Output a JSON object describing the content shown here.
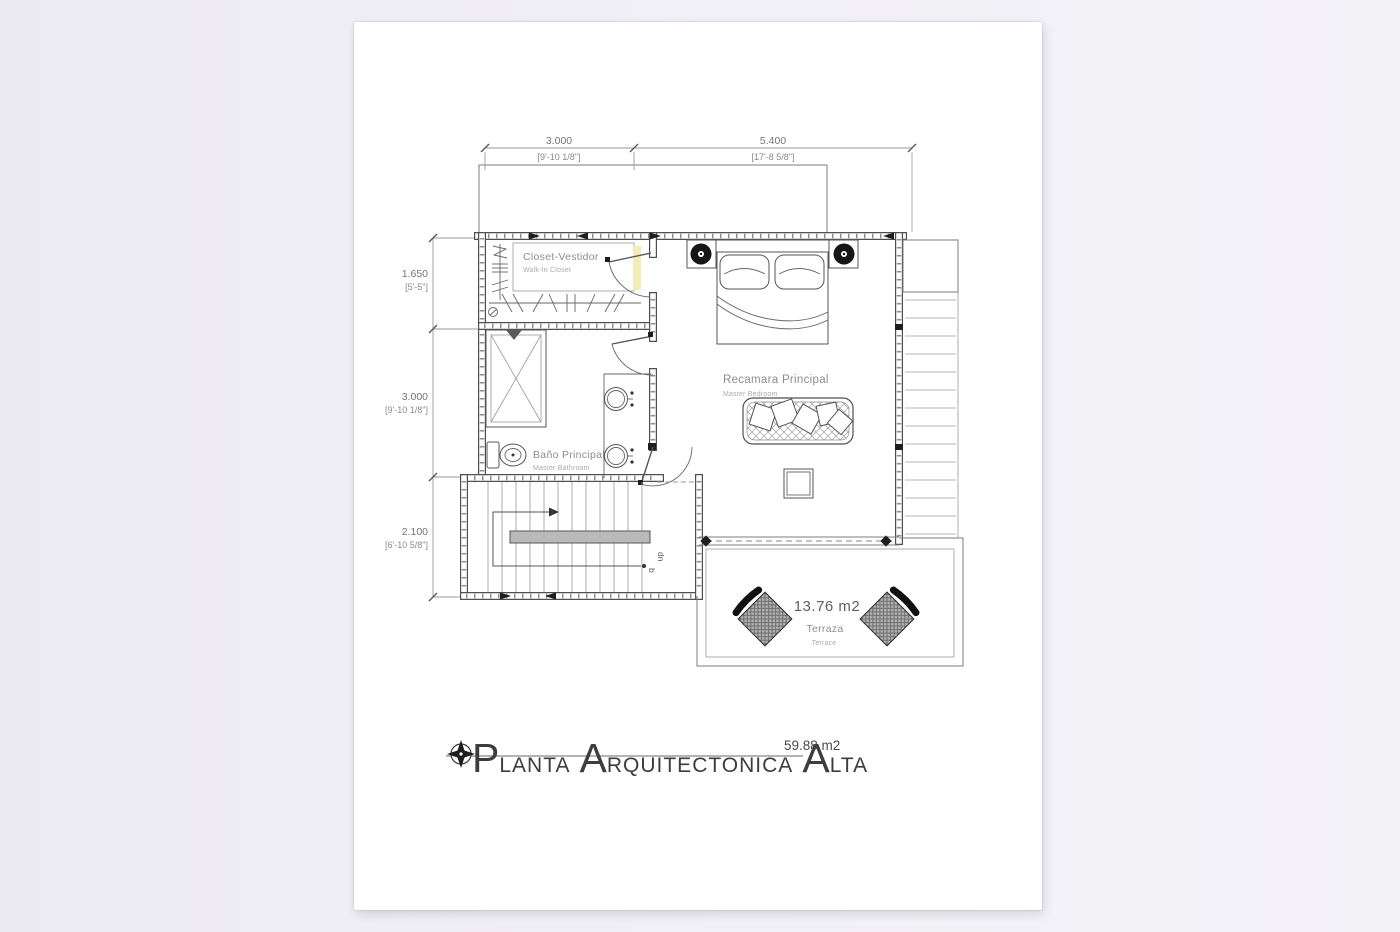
{
  "sheet": {
    "background": "#ffffff",
    "canvas_background": "#eff0f4"
  },
  "plan": {
    "rooms": {
      "closet": {
        "name": "Closet-Vestidor",
        "name_en": "Walk-In Closet"
      },
      "bathroom": {
        "name": "Baño Principal",
        "name_en": "Master Bathroom"
      },
      "bedroom": {
        "name": "Recamara Principal",
        "name_en": "Master Bedroom"
      },
      "terrace": {
        "name": "Terraza",
        "name_en": "Terrace",
        "area": "13.76 m2"
      }
    },
    "stairs": {
      "down_label": "dn",
      "down_sub": "b"
    },
    "dimensions": {
      "top": [
        {
          "metric": "3.000",
          "imperial": "[9'-10 1/8\"]"
        },
        {
          "metric": "5.400",
          "imperial": "[17'-8 5/8\"]"
        }
      ],
      "left": [
        {
          "metric": "1.650",
          "imperial": "[5'-5\"]"
        },
        {
          "metric": "3.000",
          "imperial": "[9'-10 1/8\"]"
        },
        {
          "metric": "2.100",
          "imperial": "[6'-10 5/8\"]"
        }
      ]
    }
  },
  "title_block": {
    "title_words": [
      {
        "initial": "P",
        "rest": "LANTA"
      },
      {
        "initial": "A",
        "rest": "RQUITECTONICA"
      },
      {
        "initial": "A",
        "rest": "LTA"
      }
    ],
    "area": "59.88 m2"
  },
  "colors": {
    "line": "#4f4f4f",
    "thin_line": "#8a8a8a",
    "label": "#8d8d8d",
    "door_highlight": "#f3edb6",
    "handrail_fill": "#b9b9b9",
    "lamp_fill": "#161616"
  }
}
